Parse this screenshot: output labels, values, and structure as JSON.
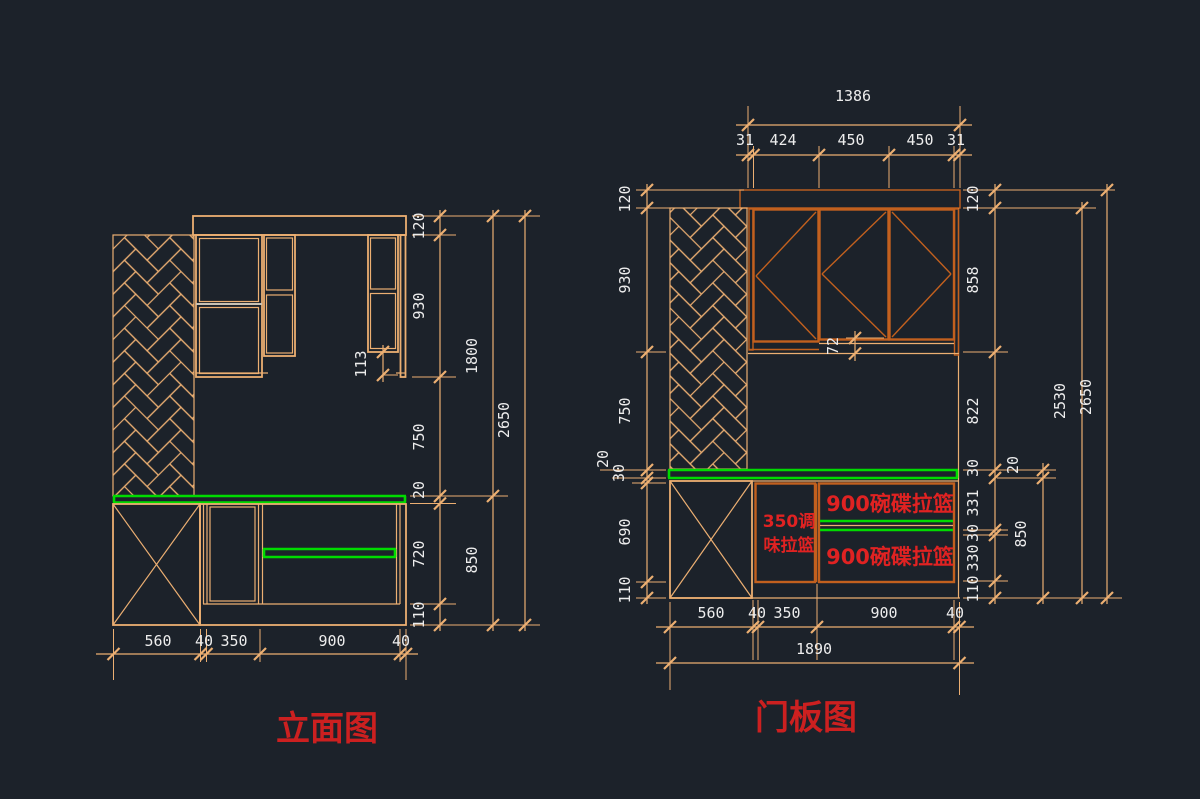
{
  "app": {
    "canvas_background": "#1c222a"
  },
  "colors": {
    "line_tan": "#ecaf72",
    "door_orange": "#c2601e",
    "highlight_green": "#00db00",
    "label_red": "#e02222",
    "title_red": "#cc2020",
    "dim_text_white": "#ededed",
    "shelf_gray": "#c9c2b4"
  },
  "left_view": {
    "title": "立面图",
    "dims": {
      "v1": [
        "120",
        "930",
        "750",
        "20",
        "720",
        "110"
      ],
      "v2": [
        "1800",
        "850"
      ],
      "v3": "2650",
      "bottom": [
        "560",
        "40",
        "350",
        "900",
        "40"
      ],
      "d113": "113"
    }
  },
  "right_view": {
    "title": "门板图",
    "dims": {
      "top_total": "1386",
      "top": [
        "31",
        "424",
        "450",
        "450",
        "31"
      ],
      "left": [
        "120",
        "930",
        "750",
        "20",
        "30",
        "690",
        "110"
      ],
      "v1": [
        "120",
        "858",
        "822",
        "30",
        "331",
        "30",
        "330",
        "110"
      ],
      "v2": [
        "20",
        "850"
      ],
      "v3": "2530",
      "v4": "2650",
      "bottom": [
        "560",
        "40",
        "350",
        "900",
        "40"
      ],
      "bottom_total": "1890",
      "d72": "72"
    },
    "labels": {
      "spice1": "350调",
      "spice2": "味拉篮",
      "dish1": "900碗碟拉篮",
      "dish2": "900碗碟拉篮"
    }
  }
}
